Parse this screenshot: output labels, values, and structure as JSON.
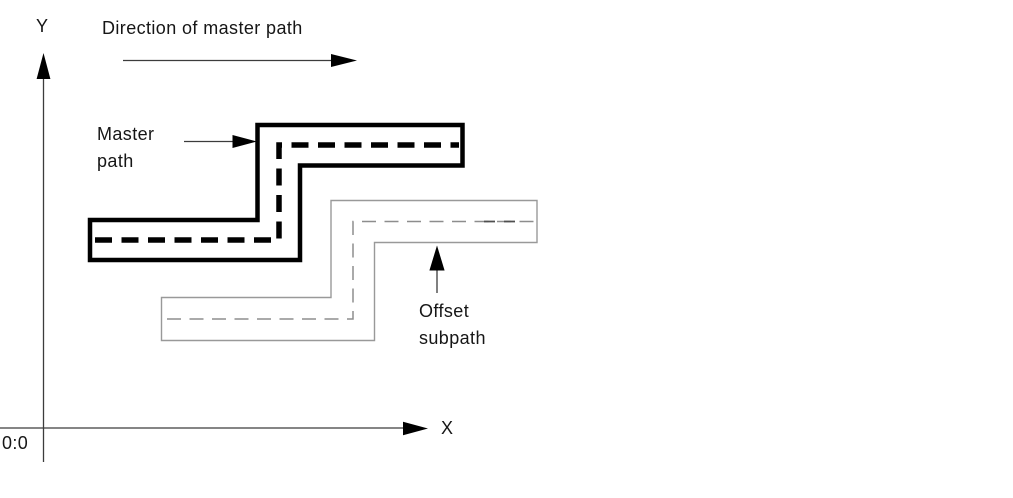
{
  "figure": {
    "background_color": "#ffffff",
    "ink_color": "#000000",
    "outline_fill": "#ffffff",
    "axis_color": "#3c3c3c",
    "offset_outline_color": "#999999",
    "offset_dash_color": "#8d8d8d",
    "offset_dark_dash_color": "#4f4f4f"
  },
  "labels": {
    "y_axis": "Y",
    "x_axis": "X",
    "origin": "0:0",
    "direction": "Direction of master path",
    "master_path": "Master\npath",
    "offset_subpath": "Offset\nsubpath"
  }
}
